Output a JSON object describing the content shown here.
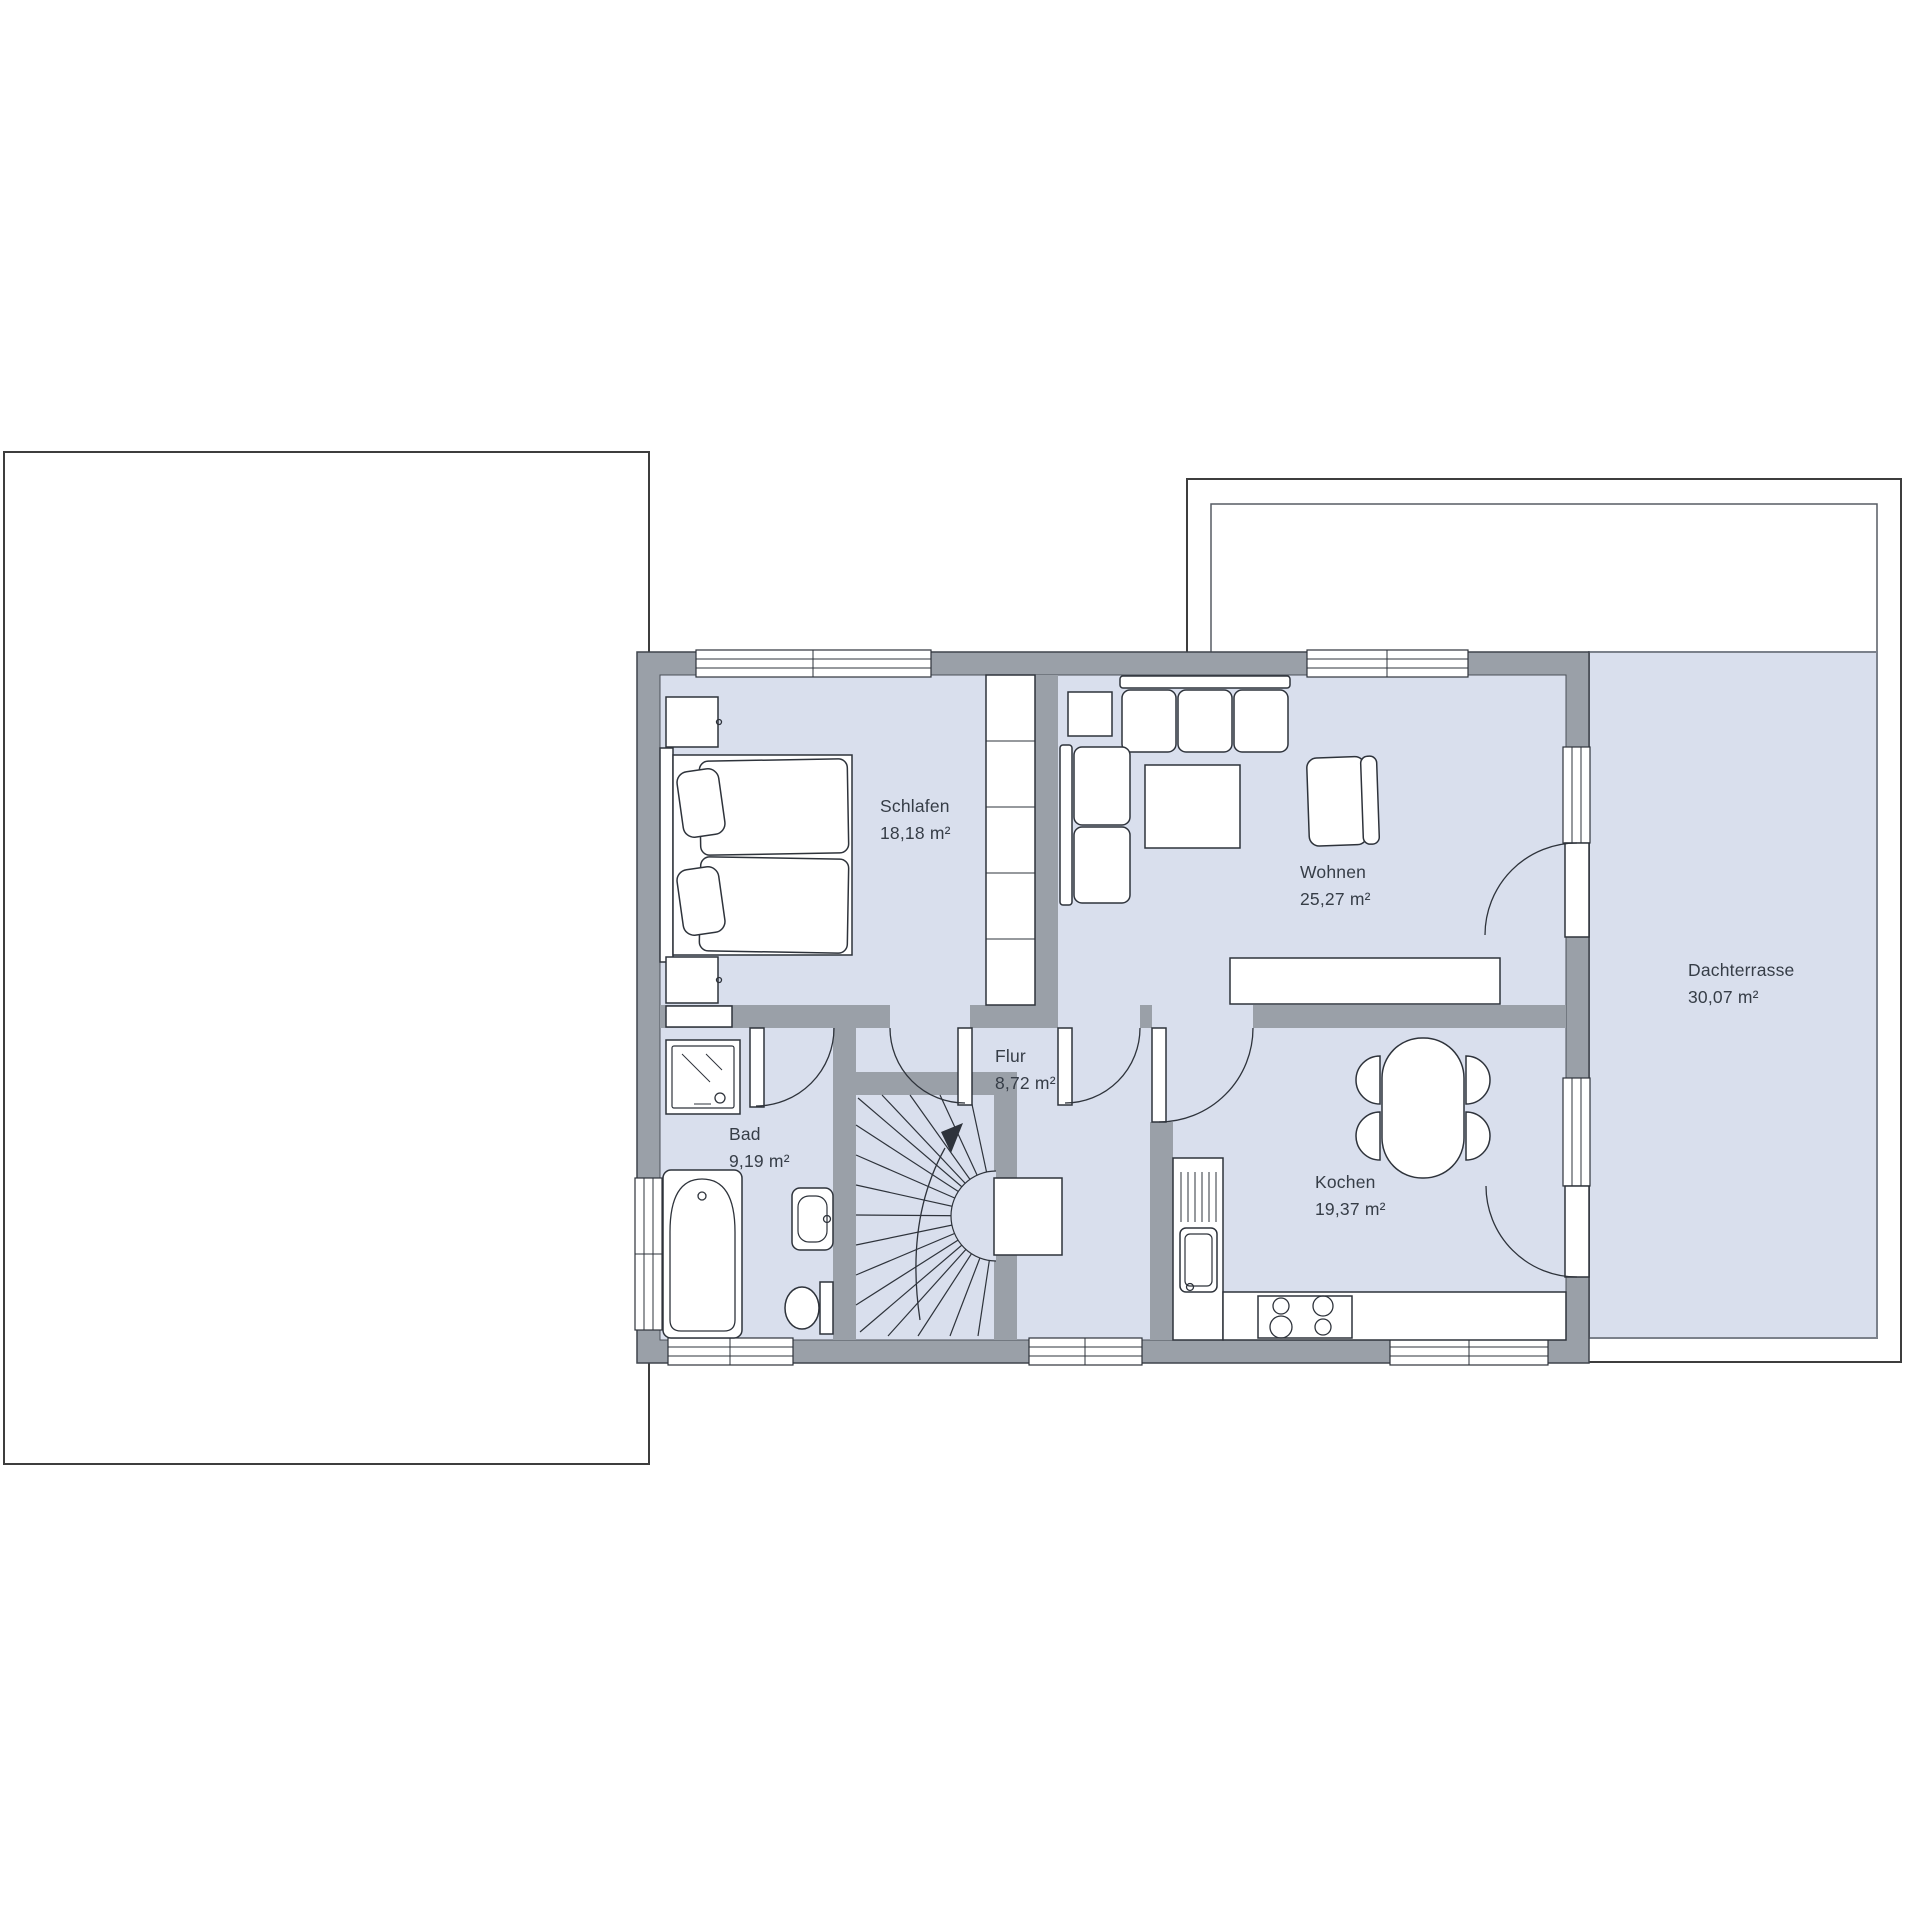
{
  "plan": {
    "rooms": [
      {
        "name": "Schlafen",
        "area": "18,18 m²"
      },
      {
        "name": "Wohnen",
        "area": "25,27 m²"
      },
      {
        "name": "Flur",
        "area": "8,72 m²"
      },
      {
        "name": "Bad",
        "area": "9,19 m²"
      },
      {
        "name": "Kochen",
        "area": "19,37 m²"
      },
      {
        "name": "Dachterrasse",
        "area": "30,07 m²"
      }
    ],
    "colors": {
      "floor": "#d9dfed",
      "wall": "#9aa0a8",
      "line": "#2e333b",
      "outline": "#3d3d3d",
      "label": "#363d47",
      "terrace_border": "#7b818b"
    }
  }
}
